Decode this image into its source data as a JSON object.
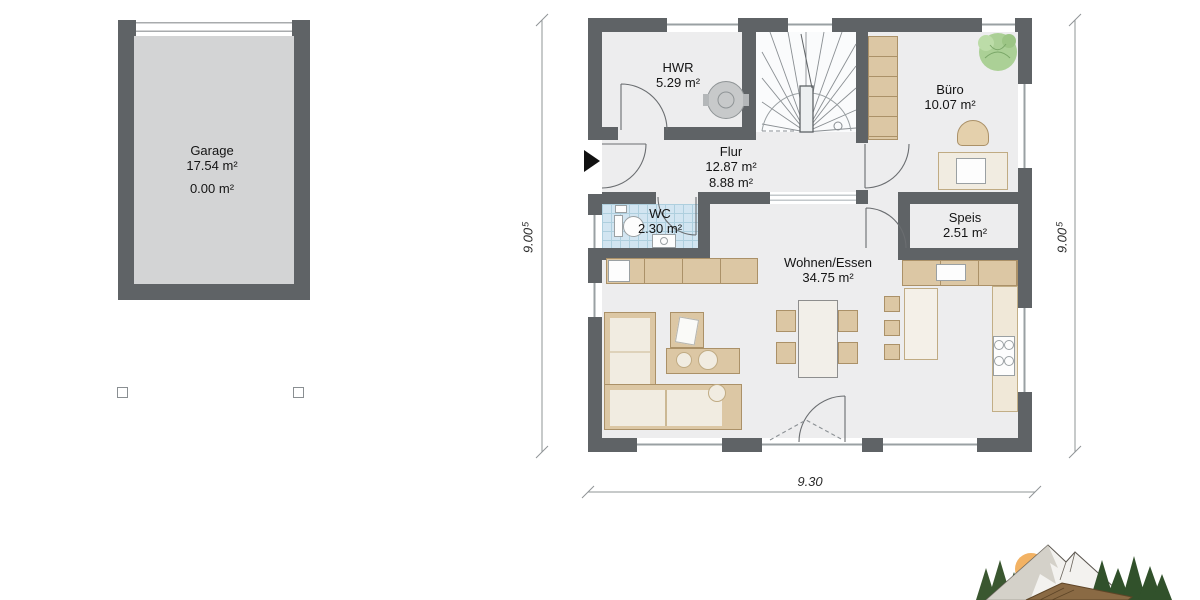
{
  "rooms": [
    {
      "id": "garage",
      "name": "Garage",
      "area": "17.54 m²",
      "area2": "0.00 m²"
    },
    {
      "id": "hwr",
      "name": "HWR",
      "area": "5.29 m²"
    },
    {
      "id": "flur",
      "name": "Flur",
      "area": "12.87 m²",
      "area2": "8.88 m²"
    },
    {
      "id": "buero",
      "name": "Büro",
      "area": "10.07 m²"
    },
    {
      "id": "wc",
      "name": "WC",
      "area": "2.30 m²"
    },
    {
      "id": "speis",
      "name": "Speis",
      "area": "2.51 m²"
    },
    {
      "id": "wohnen",
      "name": "Wohnen/Essen",
      "area": "34.75 m²"
    }
  ],
  "dims": {
    "left": {
      "value": "9.00",
      "sup": "5"
    },
    "right": {
      "value": "9.00",
      "sup": "5"
    },
    "bottom": {
      "value": "9.30"
    }
  },
  "colors": {
    "wall": "#5f6366",
    "room_floor": "#ededee",
    "garage_floor": "#d3d4d5",
    "wc_floor": "#d2e5f1",
    "furniture_tan": "#dcc7a4",
    "upholstery": "#f1ece1",
    "plant_green": "#a8cf90",
    "logo_sun": "#f2b264",
    "logo_tree": "#3a5730",
    "dimension_text": "#2c2c2c"
  }
}
